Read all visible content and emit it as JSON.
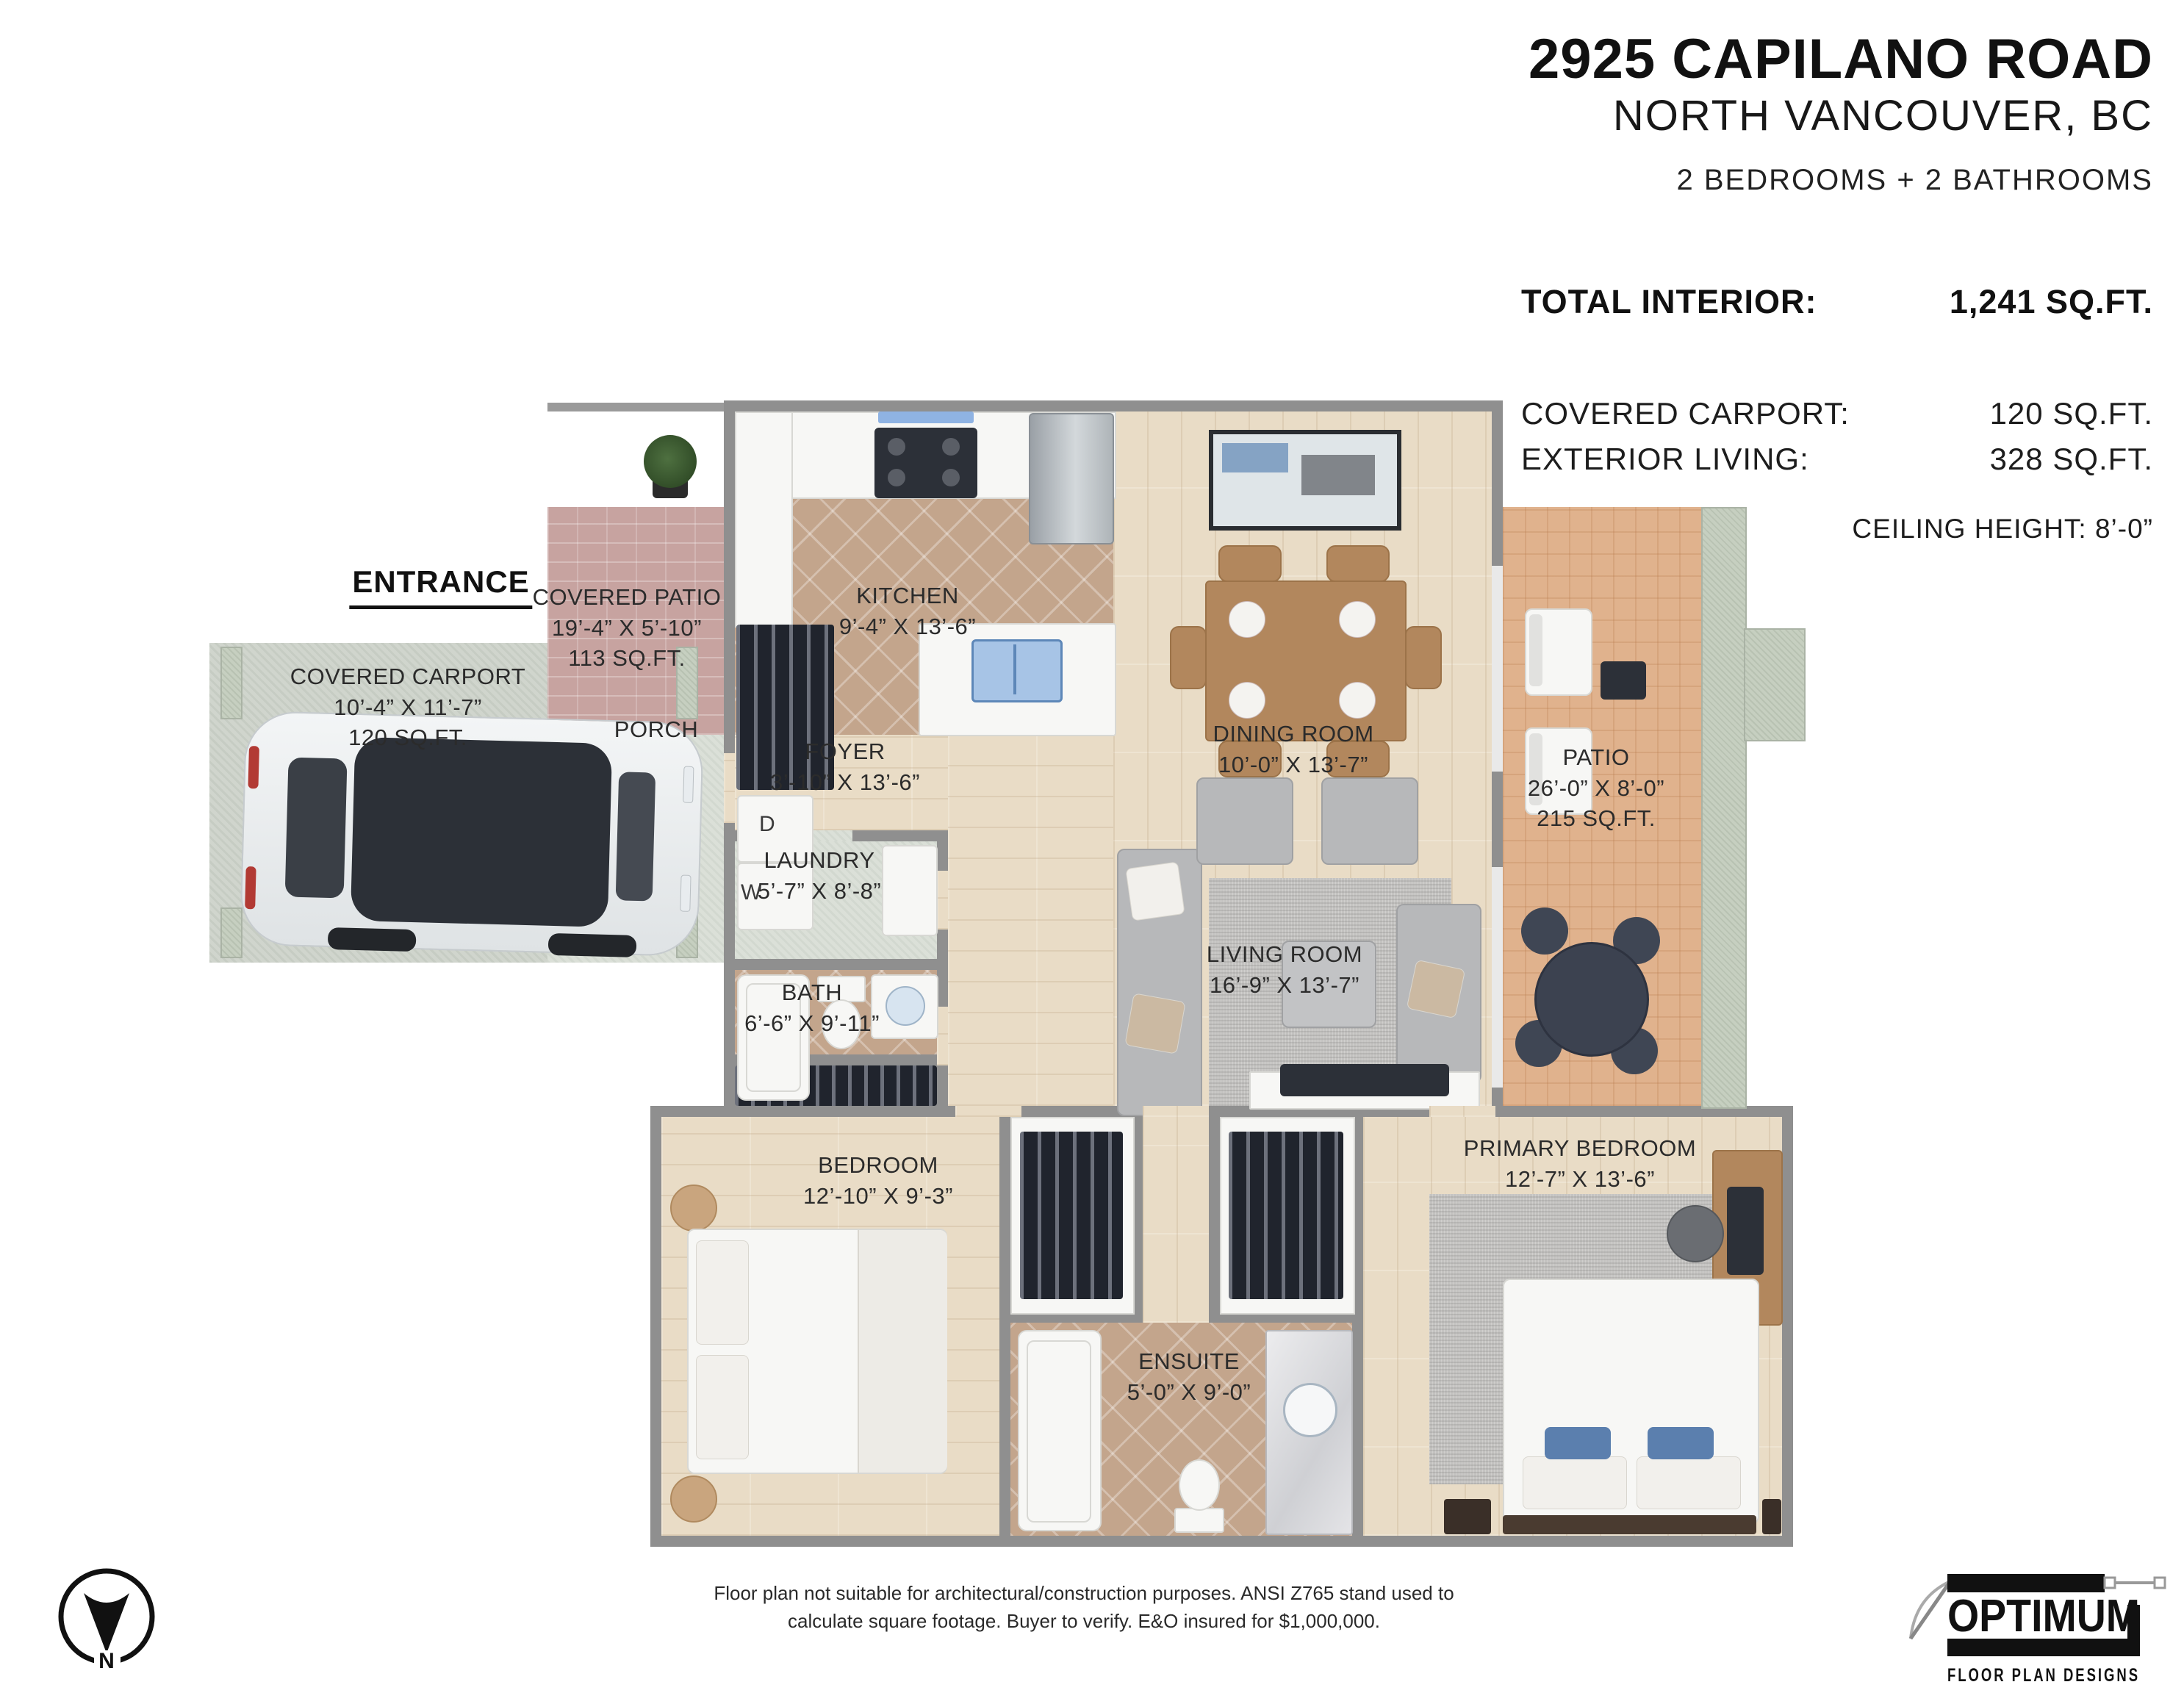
{
  "header": {
    "address": "2925 CAPILANO ROAD",
    "city": "NORTH VANCOUVER, BC",
    "rooms_summary": "2 BEDROOMS + 2 BATHROOMS"
  },
  "stats": {
    "total_interior_label": "TOTAL INTERIOR:",
    "total_interior_value": "1,241 SQ.FT.",
    "covered_carport_label": "COVERED CARPORT:",
    "covered_carport_value": "120 SQ.FT.",
    "exterior_living_label": "EXTERIOR LIVING:",
    "exterior_living_value": "328 SQ.FT.",
    "ceiling_height": "CEILING HEIGHT: 8’-0”"
  },
  "rooms": {
    "entrance": {
      "name": "ENTRANCE"
    },
    "covered_patio": {
      "name": "COVERED PATIO",
      "dims": "19’-4” X 5’-10”",
      "area": "113 SQ.FT."
    },
    "covered_carport": {
      "name": "COVERED CARPORT",
      "dims": "10’-4” X 11’-7”",
      "area": "120 SQ.FT."
    },
    "porch": {
      "name": "PORCH"
    },
    "kitchen": {
      "name": "KITCHEN",
      "dims": "9’-4” X 13’-6”"
    },
    "foyer": {
      "name": "FOYER",
      "dims": "3’-10” X 13’-6”"
    },
    "laundry": {
      "name": "LAUNDRY",
      "dims": "5’-7” X 8’-8”"
    },
    "dining_room": {
      "name": "DINING ROOM",
      "dims": "10’-0” X 13’-7”"
    },
    "patio": {
      "name": "PATIO",
      "dims": "26’-0” X 8’-0”",
      "area": "215 SQ.FT."
    },
    "living_room": {
      "name": "LIVING ROOM",
      "dims": "16’-9” X 13’-7”"
    },
    "bath": {
      "name": "BATH",
      "dims": "6’-6” X 9’-11”"
    },
    "bedroom": {
      "name": "BEDROOM",
      "dims": "12’-10” X 9’-3”"
    },
    "primary_bedroom": {
      "name": "PRIMARY BEDROOM",
      "dims": "12’-7” X 13’-6”"
    },
    "ensuite": {
      "name": "ENSUITE",
      "dims": "5’-0” X 9’-0”"
    }
  },
  "appliances": {
    "washer": "W",
    "dryer": "D"
  },
  "compass": {
    "north": "N"
  },
  "footer": {
    "disclaimer_line1": "Floor plan not suitable for architectural/construction purposes. ANSI Z765 stand used to",
    "disclaimer_line2": "calculate square footage. Buyer to verify.  E&O insured for $1,000,000.",
    "logo_title": "OPTIMUM",
    "logo_subtitle": "FLOOR PLAN DESIGNS"
  }
}
